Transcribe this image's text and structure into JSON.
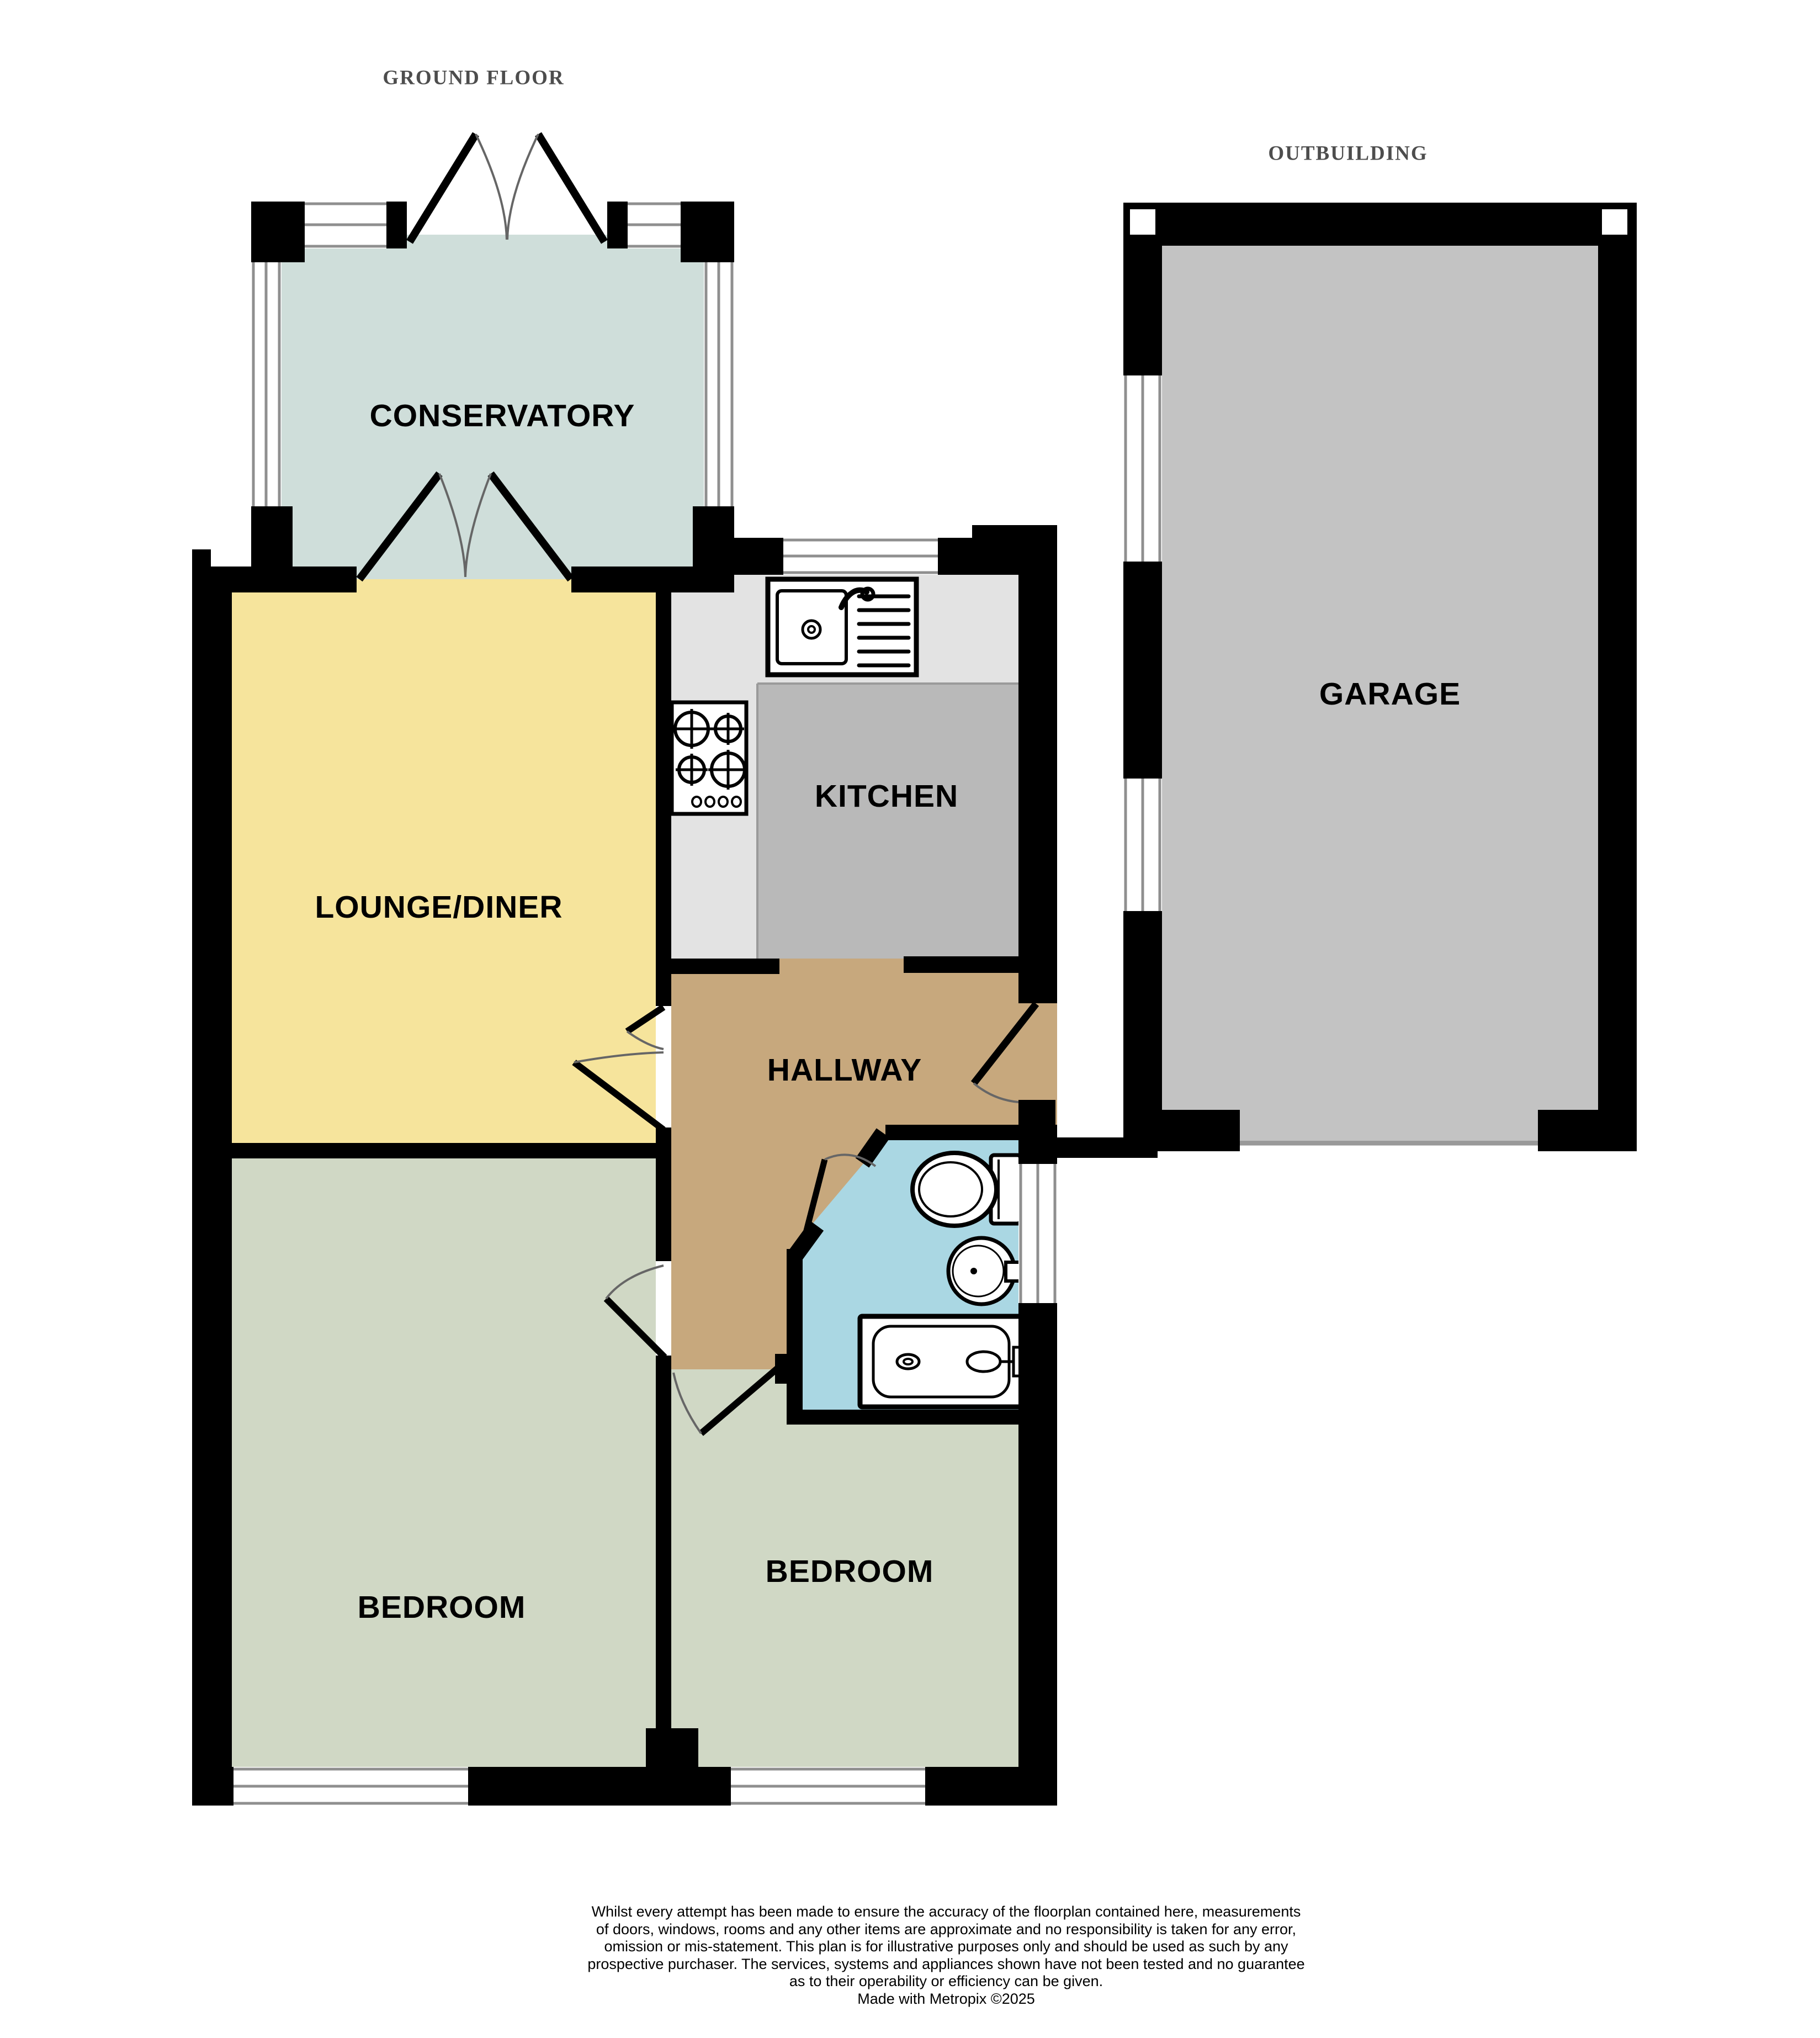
{
  "titles": {
    "ground_floor": "GROUND FLOOR",
    "outbuilding": "OUTBUILDING"
  },
  "rooms": {
    "conservatory": {
      "label": "CONSERVATORY"
    },
    "lounge_diner": {
      "label": "LOUNGE/DINER"
    },
    "kitchen": {
      "label": "KITCHEN"
    },
    "hallway": {
      "label": "HALLWAY"
    },
    "bedroom_1": {
      "label": "BEDROOM"
    },
    "bedroom_2": {
      "label": "BEDROOM"
    },
    "garage": {
      "label": "GARAGE"
    }
  },
  "colors": {
    "wall": "#000000",
    "conservatory": "#cfdeda",
    "lounge": "#f6e49c",
    "kitchen_floor": "#b9b9b9",
    "kitchen_counter": "#e3e3e3",
    "hallway": "#c7a87d",
    "bathroom": "#aad7e3",
    "bedroom": "#d0d8c5",
    "garage": "#c3c3c3",
    "window_fill": "#ffffff",
    "window_line": "#8f8f8f",
    "door_leaf": "#000000",
    "door_arc": "#666666",
    "garage_door_line": "#999999",
    "title_text": "#4d4d4d",
    "label_text": "#000000"
  },
  "icons": {
    "kitchen_sink": "sink-icon",
    "hob": "hob-icon",
    "toilet": "toilet-icon",
    "basin": "basin-icon",
    "bath": "bath-icon"
  },
  "disclaimer": {
    "text": "Whilst every attempt has been made to ensure the accuracy of the floorplan contained here, measurements\nof doors, windows, rooms and any other items are approximate and no responsibility is taken for any error,\nomission or mis-statement. This plan is for illustrative purposes only and should be used as such by any\nprospective purchaser. The services, systems and appliances shown have not been tested and no guarantee\nas to their operability or efficiency can be given.",
    "credit": "Made with Metropix ©2025"
  }
}
